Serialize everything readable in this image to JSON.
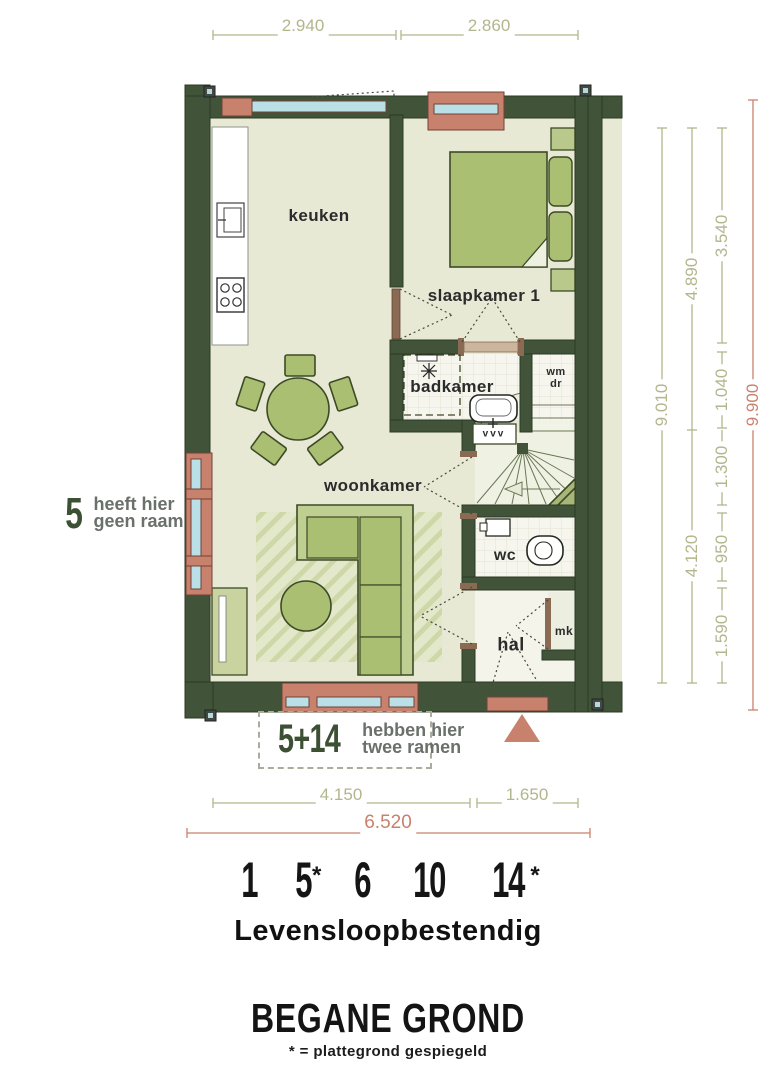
{
  "rooms": {
    "kitchen": "keuken",
    "bedroom": "slaapkamer 1",
    "bathroom": "badkamer",
    "living": "woonkamer",
    "wc": "wc",
    "hall": "hal"
  },
  "labels": {
    "wm": "wm",
    "dr": "dr",
    "mk": "mk",
    "vvv": "vvv"
  },
  "dims": {
    "top": [
      "2.940",
      "2.860"
    ],
    "right": [
      "9.010",
      "4.890",
      "4.120",
      "3.540",
      "1.040",
      "1.300",
      "950",
      "1.590",
      "9.900"
    ],
    "bottom": [
      "4.150",
      "1.650",
      "6.520"
    ]
  },
  "notes": {
    "left_num": "5",
    "left_line1": "heeft hier",
    "left_line2": "geen raam",
    "win_num": "5+14",
    "win_line1": "hebben hier",
    "win_line2": "twee ramen"
  },
  "footer": {
    "units": [
      "1",
      "5",
      "6",
      "10",
      "14"
    ],
    "stars": {
      "u2": "*",
      "u5": "*"
    },
    "subtitle": "Levensloopbestendig",
    "title": "BEGANE GROND",
    "note": "* = plattegrond gespiegeld"
  },
  "colors": {
    "wall": "#41543a",
    "wall-line": "#2c3a24",
    "floor": "#e8e9d5",
    "wet-floor": "#f6f6ee",
    "furn": "#aabf72",
    "furn-light": "#bfcf92",
    "furn-line": "#3c4a27",
    "accent": "#c8816c",
    "glass": "#badfe7",
    "dim": "#b3b68c",
    "stencil": "#3c5033",
    "gray": "#6a706a",
    "ink": "#2b2b2b"
  }
}
